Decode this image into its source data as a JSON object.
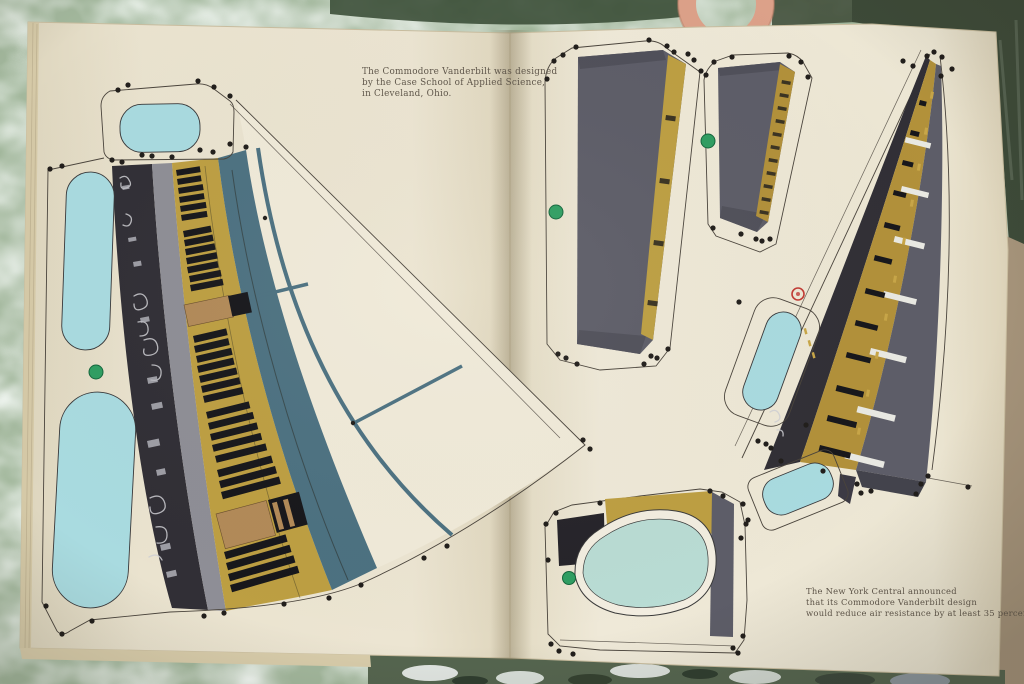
{
  "captions": {
    "designer_note": {
      "lines": [
        "The Commodore Vanderbilt was designed",
        "by the Case School of Applied Science,",
        "in Cleveland, Ohio."
      ]
    },
    "aero_note": {
      "lines": [
        "The New York Central announced",
        "that its Commodore Vanderbilt design",
        "would reduce air resistance by at least 35 percent."
      ]
    }
  },
  "colors": {
    "background_sage": "#a3b89d",
    "background_dark": "#3d4a38",
    "table_mottle_dark": "#55654f",
    "page_cream": "#e9e2cd",
    "page_cream_right": "#eee8d6",
    "page_edge_tan": "#d5c9a7",
    "right_edge_tan": "#a5937a",
    "teal_blue": "#a9dbe0",
    "teal_pale": "#b9dcd4",
    "gold_band": "#bd9f42",
    "gold_deep": "#b2913a",
    "slab_gray": "#5d5d68",
    "slab_gray_dark": "#50505a",
    "charcoal_band": "#312f36",
    "steel_blue": "#4c7181",
    "mid_gray": "#8e8e96",
    "door_tan": "#b28a58",
    "window_black": "#17171b",
    "marker_green": "#2f9e62",
    "marker_green_rim": "#14663c",
    "marker_red": "#c23b34",
    "cut_line": "#4a443c",
    "ink_text": "#5f564a",
    "scissors_handle": "#dca189",
    "tie_white": "#e9e9e3"
  }
}
